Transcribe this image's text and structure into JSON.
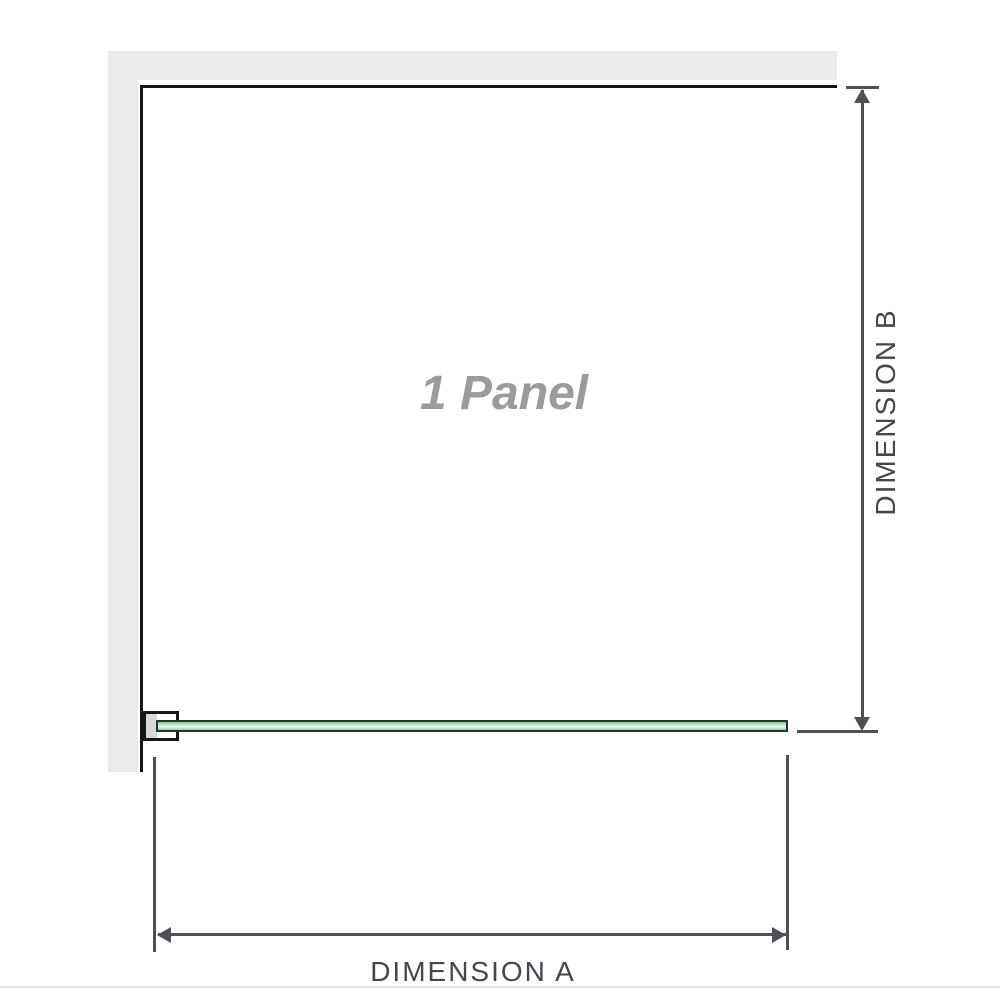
{
  "diagram": {
    "panel_label": "1 Panel",
    "dimension_a": {
      "label": "DIMENSION A"
    },
    "dimension_b": {
      "label": "DIMENSION B"
    }
  },
  "colors": {
    "wall_fill": "#eaeaea",
    "wall_edge": "#151515",
    "glass_border": "#24352a",
    "glass_green": "#8fcda1",
    "glass_highlight": "#f0f8f2",
    "bracket_fill": "#ffffff",
    "bracket_pad": "#d8d8d8",
    "dimension_line": "#4d5156",
    "dimension_text": "#43484d",
    "panel_text": "#9b9b9b",
    "baseline_rule": "#e9e4dd",
    "background": "#ffffff"
  }
}
